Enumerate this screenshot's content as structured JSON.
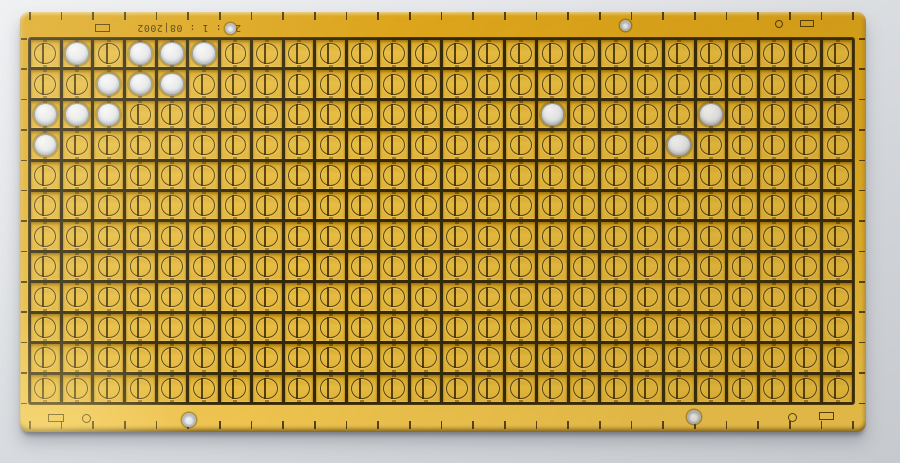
{
  "scene": {
    "description": "Photograph of a gold-plated PCB panel lying on a light gray surface; panel holds a dense grid of identical square pads, each etched with a circle-and-bar pattern",
    "background_top_color": "#f0f1f3",
    "background_bottom_color": "#c6c9cd"
  },
  "board": {
    "material": "gold-plated panel",
    "gold_color": "#e2ae24",
    "etch_line_color": "#38290a",
    "unplated_pad_color": "#e6e8ec",
    "date_stamp": {
      "text": "22 : 1 : 08|2002",
      "orientation": "rotated-180"
    },
    "grid": {
      "columns": 26,
      "rows": 12,
      "cell_glyph": "circle-outline-with-vertical-bar",
      "white_pads_col_row": [
        [
          2,
          1
        ],
        [
          4,
          1
        ],
        [
          5,
          1
        ],
        [
          6,
          1
        ],
        [
          3,
          2
        ],
        [
          4,
          2
        ],
        [
          5,
          2
        ],
        [
          1,
          3
        ],
        [
          2,
          3
        ],
        [
          3,
          3
        ],
        [
          1,
          4
        ],
        [
          17,
          3
        ],
        [
          22,
          3
        ],
        [
          21,
          4
        ]
      ]
    },
    "ruler_ticks": {
      "top_count": 27,
      "bottom_count": 27,
      "left_count": 13,
      "right_count": 13
    },
    "markings": [
      {
        "name": "fiducial-rect-top-left",
        "type": "rect-outline",
        "cx": 82,
        "cy": 16,
        "w": 15,
        "h": 8
      },
      {
        "name": "tooling-hole-top-left",
        "type": "hole",
        "cx": 210,
        "cy": 16,
        "d": 11
      },
      {
        "name": "tooling-hole-top-mid",
        "type": "hole",
        "cx": 605,
        "cy": 13,
        "d": 11
      },
      {
        "name": "fiducial-circle-top-right",
        "type": "circle-outline",
        "cx": 759,
        "cy": 12,
        "d": 8
      },
      {
        "name": "fiducial-rect-top-right",
        "type": "rect-outline",
        "cx": 787,
        "cy": 11,
        "w": 14,
        "h": 7
      },
      {
        "name": "fiducial-rect-bottom-left",
        "type": "rect-outline",
        "cx": 36,
        "cy": 406,
        "w": 16,
        "h": 8
      },
      {
        "name": "fiducial-circle-bottom-left",
        "type": "circle-outline",
        "cx": 66,
        "cy": 406,
        "d": 9
      },
      {
        "name": "tooling-hole-bottom-left",
        "type": "hole",
        "cx": 169,
        "cy": 408,
        "d": 14
      },
      {
        "name": "tooling-hole-bottom-mid",
        "type": "hole",
        "cx": 674,
        "cy": 405,
        "d": 14
      },
      {
        "name": "fiducial-circle-bottom-right",
        "type": "circle-outline",
        "cx": 772,
        "cy": 405,
        "d": 9
      },
      {
        "name": "fiducial-rect-bottom-right",
        "type": "rect-outline",
        "cx": 806,
        "cy": 404,
        "w": 15,
        "h": 8
      }
    ]
  }
}
